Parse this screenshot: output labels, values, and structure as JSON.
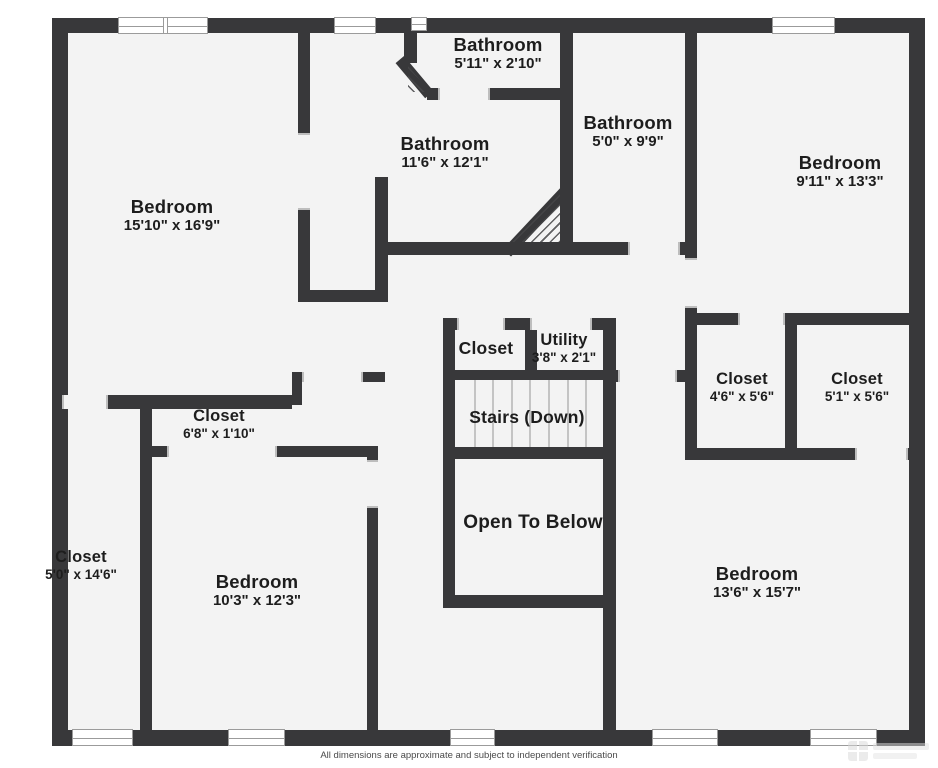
{
  "page": {
    "background_color": "#ffffff",
    "wall_color": "#38383a",
    "floor_color": "#f3f3f3"
  },
  "rooms": [
    {
      "name": "Bedroom",
      "dims": "15'10\" x 16'9\""
    },
    {
      "name": "Bathroom",
      "dims": "11'6\" x 12'1\""
    },
    {
      "name": "Bathroom",
      "dims": "5'11\" x 2'10\""
    },
    {
      "name": "Bathroom",
      "dims": "5'0\" x 9'9\""
    },
    {
      "name": "Bedroom",
      "dims": "9'11\" x 13'3\""
    },
    {
      "name": "Closet",
      "dims": ""
    },
    {
      "name": "Utility",
      "dims": "3'8\" x 2'1\""
    },
    {
      "name": "Stairs (Down)",
      "dims": ""
    },
    {
      "name": "Open To Below",
      "dims": ""
    },
    {
      "name": "Closet",
      "dims": "4'6\" x 5'6\""
    },
    {
      "name": "Closet",
      "dims": "5'1\" x 5'6\""
    },
    {
      "name": "Closet",
      "dims": "6'8\" x 1'10\""
    },
    {
      "name": "Closet",
      "dims": "5'0\" x 14'6\""
    },
    {
      "name": "Bedroom",
      "dims": "10'3\" x 12'3\""
    },
    {
      "name": "Bedroom",
      "dims": "13'6\" x 15'7\""
    }
  ],
  "footer": {
    "disclaimer": "All dimensions are approximate and subject to independent verification"
  }
}
